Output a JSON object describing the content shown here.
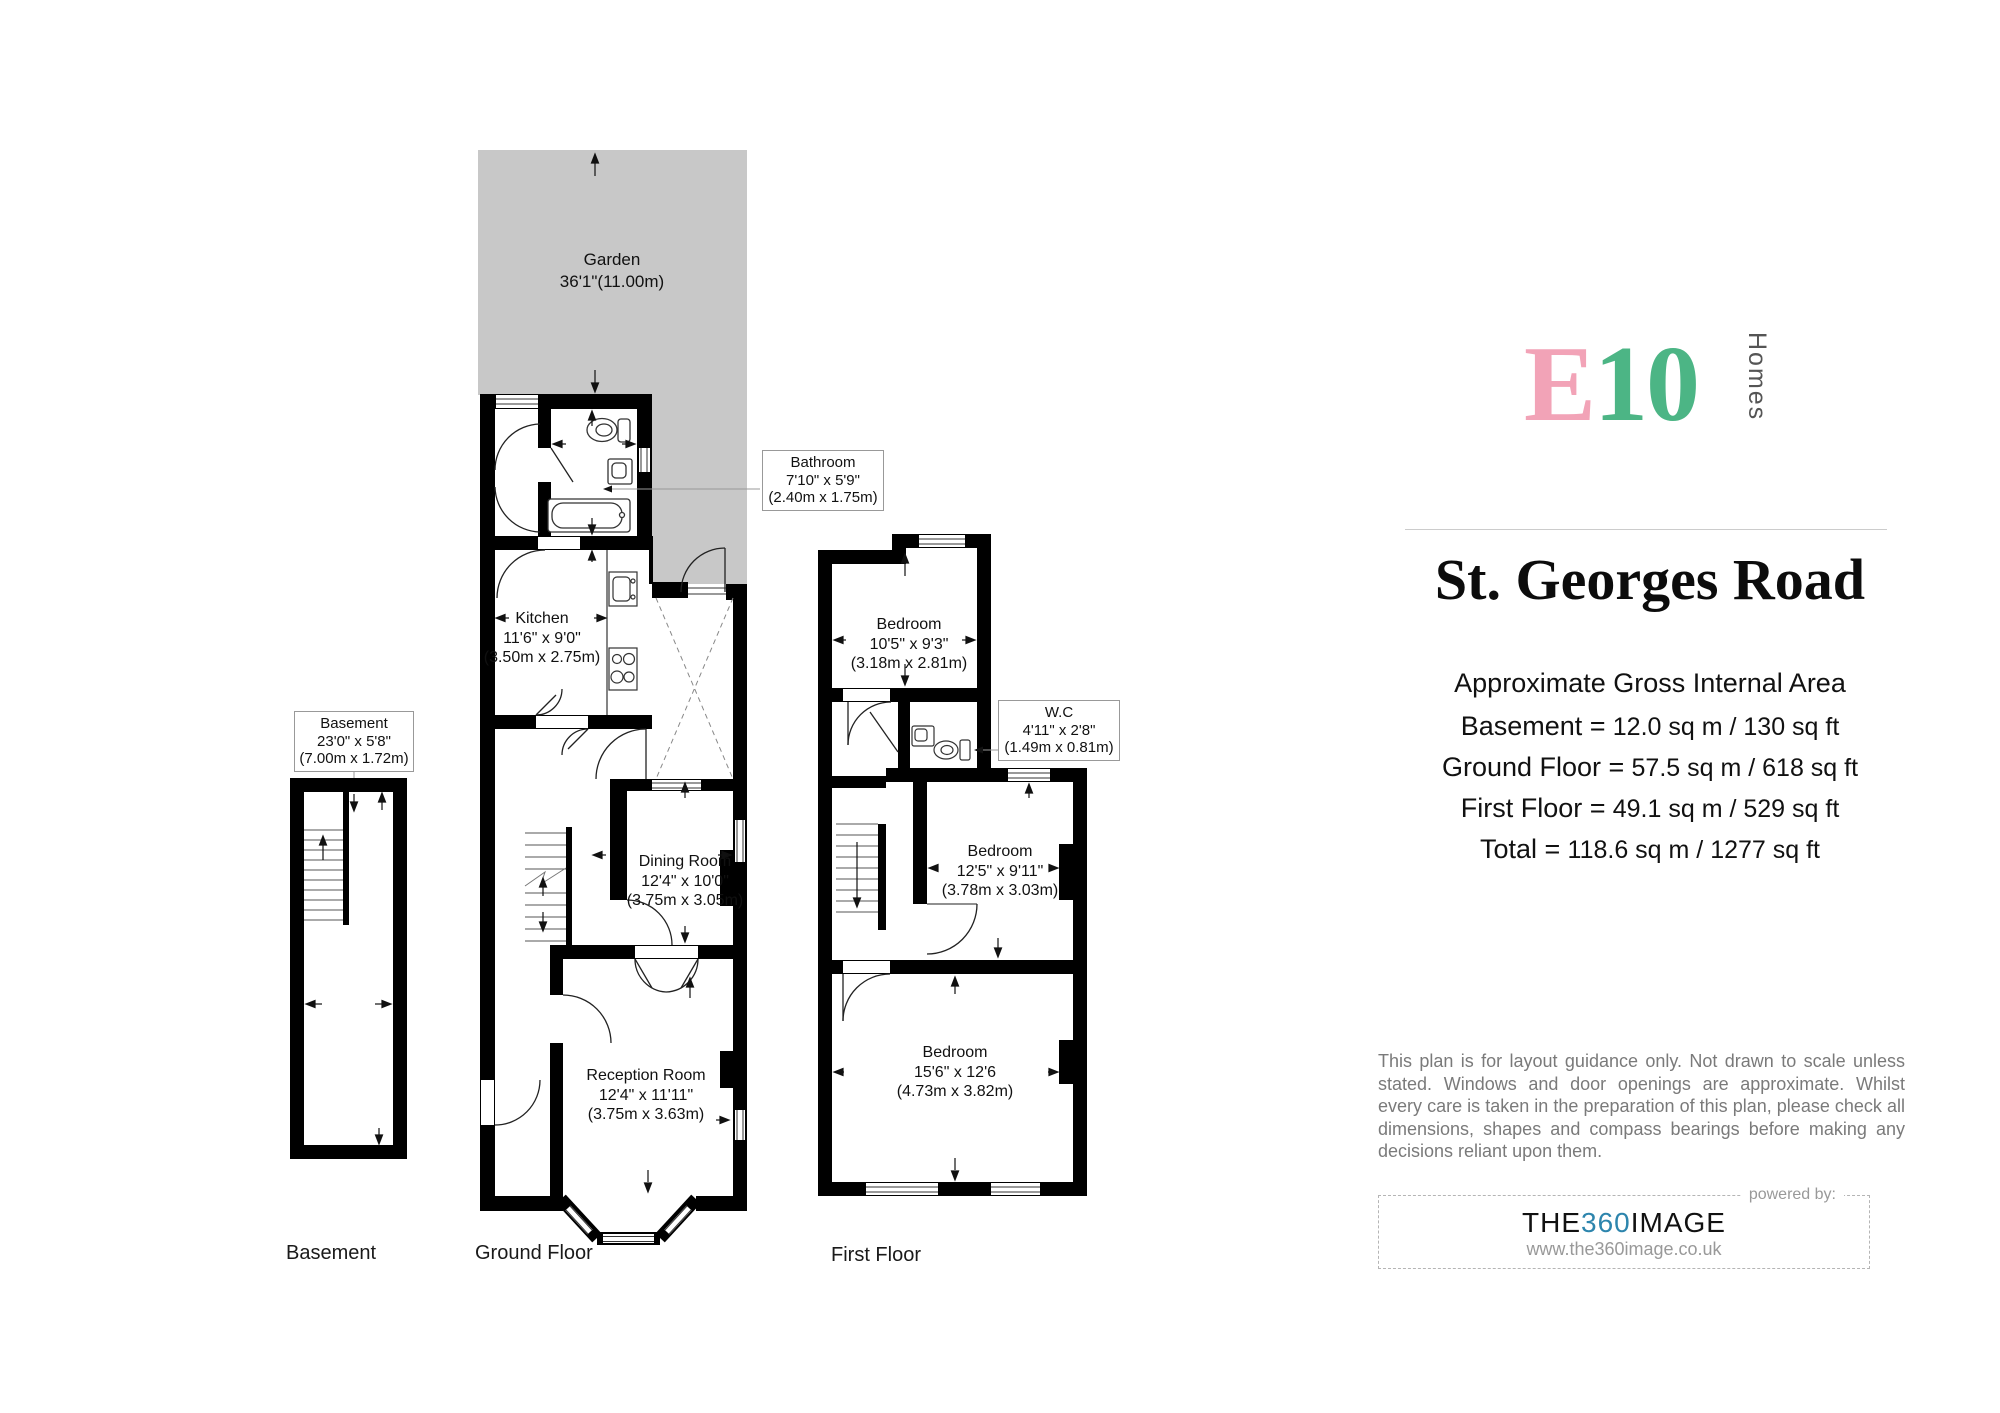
{
  "plan": {
    "colors": {
      "garden_gray": "#c8c8c8",
      "wall_black": "#000000"
    },
    "floors": {
      "basement": {
        "floor_label": "Basement",
        "room_box": {
          "name": "Basement",
          "imperial": "23'0\" x 5'8\"",
          "metric": "(7.00m x 1.72m)"
        }
      },
      "ground": {
        "floor_label": "Ground Floor",
        "garden": {
          "name": "Garden",
          "dims": "36'1\"(11.00m)"
        },
        "bathroom_box": {
          "name": "Bathroom",
          "imperial": "7'10\" x 5'9\"",
          "metric": "(2.40m x 1.75m)"
        },
        "kitchen": {
          "name": "Kitchen",
          "imperial": "11'6\" x 9'0\"",
          "metric": "(3.50m x 2.75m)"
        },
        "dining": {
          "name": "Dining Room",
          "imperial": "12'4\" x 10'0\"",
          "metric": "(3.75m x 3.05m)"
        },
        "reception": {
          "name": "Reception Room",
          "imperial": "12'4\" x 11'11\"",
          "metric": "(3.75m x 3.63m)"
        }
      },
      "first": {
        "floor_label": "First Floor",
        "bedroom_back": {
          "name": "Bedroom",
          "imperial": "10'5\" x 9'3\"",
          "metric": "(3.18m x 2.81m)"
        },
        "wc_box": {
          "name": "W.C",
          "imperial": "4'11\" x 2'8\"",
          "metric": "(1.49m x 0.81m)"
        },
        "bedroom_middle": {
          "name": "Bedroom",
          "imperial": "12'5\" x 9'11\"",
          "metric": "(3.78m x 3.03m)"
        },
        "bedroom_front": {
          "name": "Bedroom",
          "imperial": "15'6\" x 12'6",
          "metric": "(4.73m x 3.82m)"
        }
      }
    }
  },
  "sidebar": {
    "logo": {
      "e": "E",
      "ten": "10",
      "sub": "Homes",
      "pink": "#F2A3B7",
      "green": "#4CB585"
    },
    "title": "St. Georges Road",
    "area_heading": "Approximate Gross Internal Area",
    "areas": [
      {
        "label": "Basement =",
        "value": "12.0 sq m / 130 sq ft"
      },
      {
        "label": "Ground Floor =",
        "value": "57.5 sq m / 618 sq ft"
      },
      {
        "label": "First Floor =",
        "value": "49.1 sq m / 529 sq ft"
      },
      {
        "label": "Total  =",
        "value": "118.6 sq m / 1277 sq ft"
      }
    ],
    "disclaimer": "This plan is for layout guidance only. Not drawn to scale unless stated. Windows and door openings are approximate. Whilst every care is taken in the preparation of this plan, please check all dimensions, shapes and compass bearings before making any decisions reliant upon them.",
    "powered": {
      "label": "powered by:",
      "brand_pre": "THE",
      "brand_mid": "360",
      "brand_post": "IMAGE",
      "url": "www.the360image.co.uk",
      "blue": "#2D85AD"
    }
  }
}
